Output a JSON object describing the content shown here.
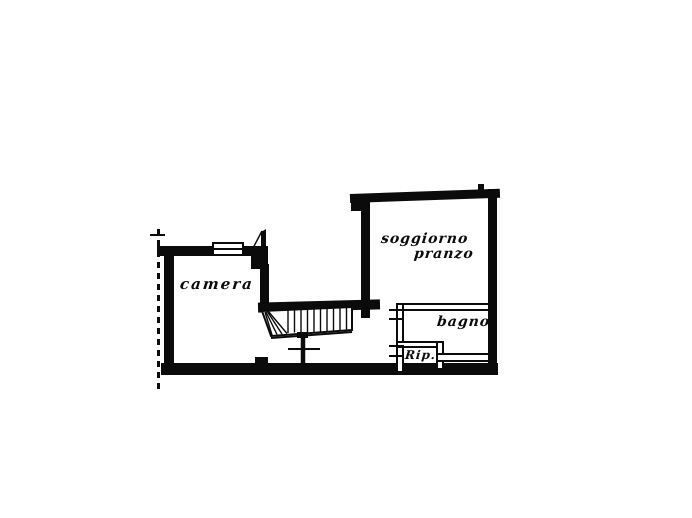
{
  "document": {
    "kind": "floor-plan-sketch",
    "colors": {
      "ink": "#0b0b0b",
      "paper": "#ffffff"
    }
  },
  "rooms": [
    {
      "name": "camera",
      "label": "camera"
    },
    {
      "name": "soggiorno-pranzo",
      "label_line1": "soggiorno",
      "label_line2": "pranzo"
    },
    {
      "name": "bagno",
      "label": "bagno"
    },
    {
      "name": "ripostiglio",
      "label": "Rip."
    }
  ],
  "symbols": {
    "staircase": "winder-stairs-with-treads",
    "window": "double-line-rectangle",
    "door": "angled-leaf-flag",
    "property_line": "dashed-vertical-line",
    "handrail_section": "cross-mark"
  }
}
